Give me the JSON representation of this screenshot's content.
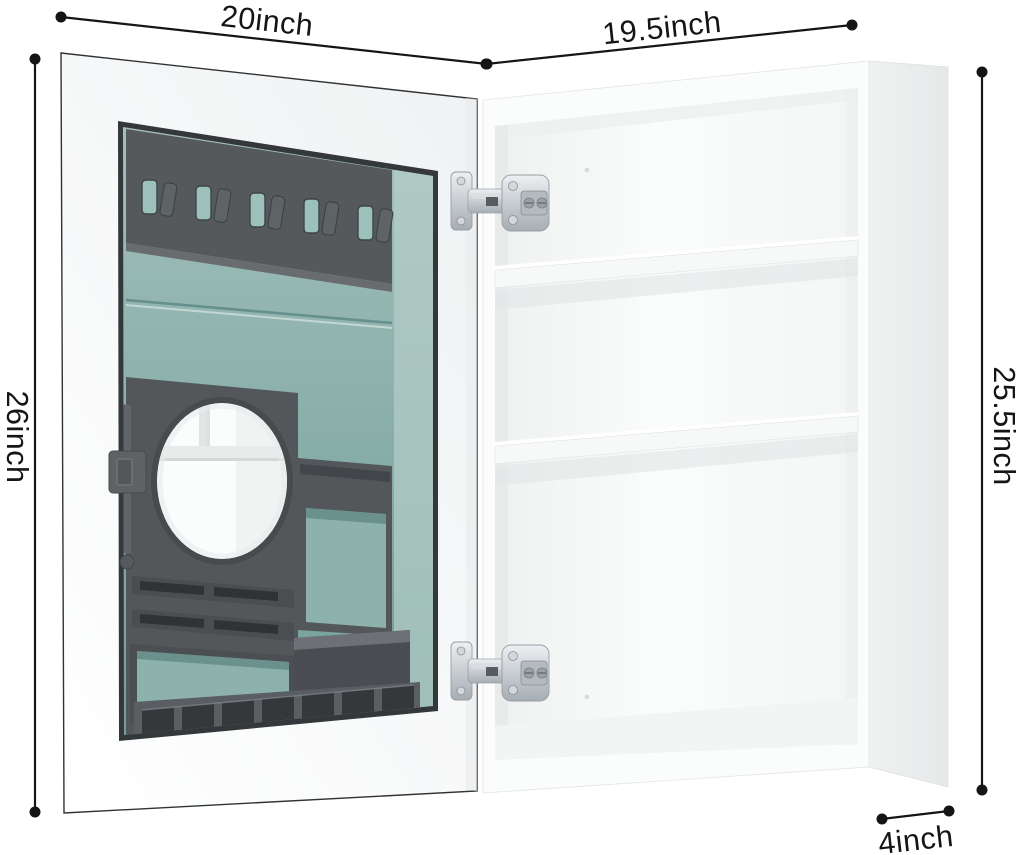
{
  "image": {
    "type": "product-dimension-diagram",
    "subject": "White bathroom medicine cabinet, open mirror door showing gray inner organizer with hooks, round mirror and bins; cabinet box with two shelves"
  },
  "dimension_labels": {
    "door_width": "20inch",
    "cabinet_width": "19.5inch",
    "door_height": "26inch",
    "cabinet_height": "25.5inch",
    "cabinet_depth": "4inch"
  },
  "counts": {
    "hooks": 5,
    "hinges": 2,
    "shelves": 2,
    "toothbrush_slots": 7
  },
  "colors": {
    "background": "#ffffff",
    "dimension_line": "#151515",
    "label_text": "#151515",
    "cabinet_front": "#fbfcfc",
    "cabinet_side": "#ebedee",
    "door_face": "#f7f8f8",
    "organizer_gray": "#55595c",
    "glass_teal": "#8fb3ae",
    "bin_teal": "#8db1ab",
    "hinge_silver": "#c3c9ce",
    "mirror": "#fbfcfc"
  }
}
